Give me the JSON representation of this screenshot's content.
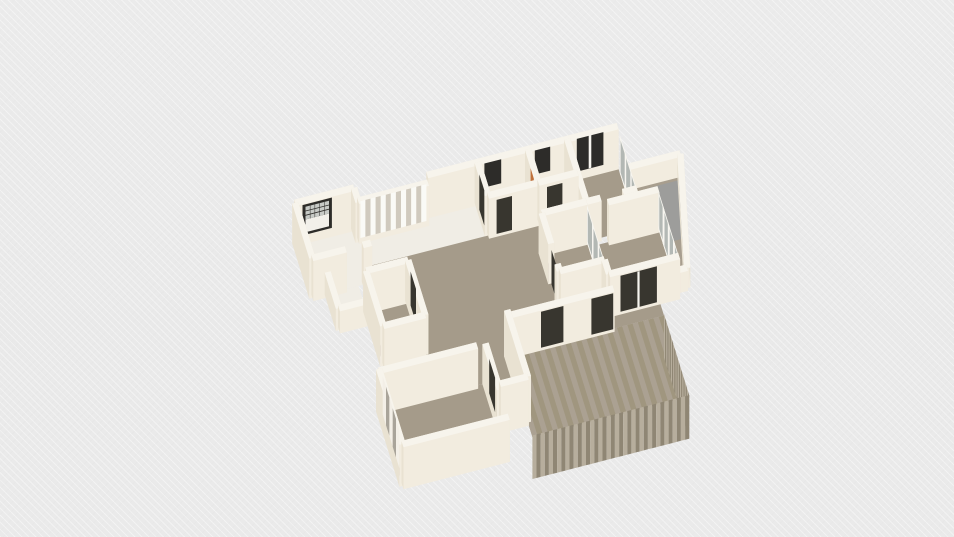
{
  "meta": {
    "app_context": "3d-floorplan-viewport",
    "background_color": "#ececec"
  },
  "view": {
    "ox": 340,
    "oy": 236,
    "ux": 28,
    "uy": -7.2,
    "vx": 9,
    "vy": 29,
    "zh": 40,
    "wall_t": 0.22
  },
  "palette": {
    "wallTop": "#f7f4ec",
    "wallH": "#f2ecdf",
    "wallV": "#e9e2d2",
    "floorWhite": "#f0ede5",
    "wood": "#a59b8a",
    "balconyFloor": "#a89e8e",
    "grayMat": "#9d9d9b",
    "deck": "#a89e8c",
    "deckA": "#aba192",
    "deckB": "#a0967f",
    "deckLight": "#b7ae9d",
    "deckDark": "#8f8674",
    "frameDark": "#2d2c29",
    "doorDark": "#38362f",
    "glass": "#b3b8b4",
    "glassLight": "#c7cac6",
    "mullion": "#f7f5ef",
    "slatLight": "#fafaf6",
    "slatDark": "#d0cabe",
    "wardrobeWhite": "#f3efe7",
    "wardrobeGray": "#a9a49a",
    "towelOrange": "#c0713c",
    "windowWhite": "#f2f0ea"
  },
  "scene": [
    {
      "k": "f",
      "n": "room-a-floor",
      "p": [
        [
          -1.45,
          -0.05
        ],
        [
          0.55,
          -0.05
        ],
        [
          0.55,
          1.75
        ],
        [
          -1.45,
          1.75
        ]
      ],
      "f": "floorWhite"
    },
    {
      "k": "f",
      "n": "entry-hall-floor",
      "p": [
        [
          0.55,
          0.1
        ],
        [
          4.9,
          0.1
        ],
        [
          4.9,
          1.25
        ],
        [
          0.55,
          1.25
        ]
      ],
      "f": "floorWhite"
    },
    {
      "k": "f",
      "n": "bath-1-floor",
      "p": [
        [
          4.9,
          0.05
        ],
        [
          6.7,
          0.05
        ],
        [
          6.7,
          1.2
        ],
        [
          4.9,
          1.2
        ]
      ],
      "f": "floorWhite"
    },
    {
      "k": "f",
      "n": "bath-2-floor",
      "p": [
        [
          6.7,
          0.05
        ],
        [
          8.1,
          0.05
        ],
        [
          8.1,
          1.2
        ],
        [
          6.7,
          1.2
        ]
      ],
      "f": "floorWhite"
    },
    {
      "k": "f",
      "n": "room-f-floor",
      "p": [
        [
          8.1,
          0.05
        ],
        [
          9.9,
          0.05
        ],
        [
          9.9,
          2.2
        ],
        [
          8.1,
          2.2
        ]
      ],
      "f": "wood"
    },
    {
      "k": "f",
      "n": "balcony-ne-floor",
      "p": [
        [
          9.9,
          0.8
        ],
        [
          11.9,
          0.8
        ],
        [
          11.4,
          3.0
        ],
        [
          10.95,
          4.5
        ],
        [
          10.6,
          4.5
        ],
        [
          10.6,
          2.5
        ],
        [
          9.9,
          2.5
        ]
      ],
      "f": "balconyFloor"
    },
    {
      "k": "f",
      "n": "balcony-ne-mat",
      "p": [
        [
          10.7,
          1.0
        ],
        [
          11.75,
          1.0
        ],
        [
          11.35,
          2.9
        ],
        [
          10.7,
          2.9
        ]
      ],
      "f": "grayMat"
    },
    {
      "k": "f",
      "n": "patio-floor",
      "p": [
        [
          -1.0,
          1.75
        ],
        [
          0.1,
          1.75
        ],
        [
          0.1,
          3.0
        ],
        [
          -1.0,
          3.0
        ]
      ],
      "f": "floorWhite"
    },
    {
      "k": "f",
      "n": "living-floor",
      "p": [
        [
          0.55,
          1.2
        ],
        [
          8.1,
          1.2
        ],
        [
          8.1,
          2.2
        ],
        [
          6.5,
          2.2
        ],
        [
          6.5,
          4.2
        ],
        [
          8.1,
          4.2
        ],
        [
          8.1,
          4.7
        ],
        [
          9.9,
          4.7
        ],
        [
          9.9,
          5.2
        ],
        [
          4.3,
          5.2
        ],
        [
          4.3,
          7.5
        ],
        [
          3.3,
          7.5
        ],
        [
          3.3,
          5.9
        ],
        [
          0.55,
          5.9
        ]
      ],
      "f": "wood"
    },
    {
      "k": "f",
      "n": "bedroom-right-floor",
      "p": [
        [
          8.1,
          2.4
        ],
        [
          10.6,
          2.4
        ],
        [
          10.6,
          4.7
        ],
        [
          8.1,
          4.7
        ]
      ],
      "f": "wood"
    },
    {
      "k": "f",
      "n": "room-i-floor",
      "p": [
        [
          6.5,
          2.2
        ],
        [
          8.1,
          2.2
        ],
        [
          8.1,
          4.2
        ],
        [
          6.5,
          4.2
        ]
      ],
      "f": "wood"
    },
    {
      "k": "f",
      "n": "closet-m-floor",
      "p": [
        [
          0.1,
          2.6
        ],
        [
          1.6,
          2.6
        ],
        [
          1.6,
          4.5
        ],
        [
          0.1,
          4.5
        ]
      ],
      "f": "wood"
    },
    {
      "k": "f",
      "n": "bedroom-sw-floor",
      "p": [
        [
          -0.5,
          5.9
        ],
        [
          3.3,
          5.9
        ],
        [
          3.3,
          8.5
        ],
        [
          -0.5,
          8.5
        ]
      ],
      "f": "wood"
    },
    {
      "k": "f",
      "n": "deck-floor",
      "p": [
        [
          4.3,
          5.2
        ],
        [
          9.9,
          5.2
        ],
        [
          9.9,
          8.0
        ],
        [
          4.3,
          8.0
        ]
      ],
      "f": "deck"
    },
    {
      "k": "fs",
      "n": "deck-floor-planks",
      "p": [
        [
          4.3,
          5.2
        ],
        [
          9.9,
          5.2
        ],
        [
          9.9,
          8.0
        ],
        [
          4.3,
          8.0
        ]
      ],
      "N": 30,
      "c1": "deckA",
      "c2": "deckB"
    },
    {
      "k": "w",
      "n": "balcony-ne-parapet-north",
      "a": [
        9.9,
        0.8
      ],
      "b": [
        11.9,
        0.8
      ],
      "h": 0.5
    },
    {
      "k": "w",
      "n": "north-exterior-wall",
      "a": [
        3.1,
        0.05
      ],
      "b": [
        9.9,
        0.05
      ]
    },
    {
      "k": "p",
      "n": "bath-1-window",
      "a": [
        5.15,
        0.02
      ],
      "b": [
        5.75,
        0.02
      ],
      "z0": 0.3,
      "z1": 0.9,
      "f": "frameDark"
    },
    {
      "k": "p",
      "n": "bath-2-window",
      "a": [
        6.95,
        0.02
      ],
      "b": [
        7.5,
        0.02
      ],
      "z0": 0.3,
      "z1": 0.9,
      "f": "frameDark"
    },
    {
      "k": "p",
      "n": "room-f-window",
      "a": [
        8.45,
        0.02
      ],
      "b": [
        9.4,
        0.02
      ],
      "z0": 0.1,
      "z1": 0.92,
      "f": "frameDark"
    },
    {
      "k": "p",
      "n": "room-f-window-mullion",
      "a": [
        8.88,
        0.01
      ],
      "b": [
        8.97,
        0.01
      ],
      "z0": 0.1,
      "z1": 0.92,
      "f": "mullion"
    },
    {
      "k": "w",
      "n": "balcony-ne-parapet-east",
      "a": [
        11.9,
        0.8
      ],
      "b": [
        10.95,
        4.5
      ],
      "h": 0.5
    },
    {
      "k": "w",
      "n": "balcony-ne-parapet-south",
      "a": [
        10.95,
        4.5
      ],
      "b": [
        10.6,
        4.5
      ],
      "h": 0.5
    },
    {
      "k": "g",
      "n": "room-f-east-glazing",
      "a": [
        9.9,
        0.3
      ],
      "b": [
        9.9,
        2.15
      ],
      "z1": 0.95,
      "N": 3
    },
    {
      "k": "w",
      "n": "room-a-north-wall",
      "a": [
        -1.55,
        -0.15
      ],
      "b": [
        0.55,
        -0.15
      ]
    },
    {
      "k": "wg",
      "n": "room-a-grid-window",
      "a": [
        -1.3,
        -0.12
      ],
      "b": [
        -0.25,
        -0.12
      ],
      "z0": 0.16,
      "z1": 0.92
    },
    {
      "k": "w",
      "n": "room-a-west-wall",
      "a": [
        -1.55,
        -0.15
      ],
      "b": [
        -1.55,
        1.75
      ]
    },
    {
      "k": "w",
      "n": "room-a-east-wall-stub",
      "a": [
        0.55,
        -0.15
      ],
      "b": [
        0.55,
        0.35
      ]
    },
    {
      "k": "w",
      "n": "closet-wall-slatted",
      "a": [
        0.55,
        0.3
      ],
      "b": [
        3.05,
        0.3
      ]
    },
    {
      "k": "s",
      "n": "closet-slat-doors",
      "a": [
        0.64,
        0.27
      ],
      "b": [
        3.0,
        0.27
      ],
      "z0": 0.03,
      "z1": 0.95,
      "N": 13,
      "c1": "slatLight",
      "c2": "slatDark"
    },
    {
      "k": "w",
      "n": "bath-1-west-wall",
      "a": [
        4.9,
        0.05
      ],
      "b": [
        4.9,
        1.2
      ]
    },
    {
      "k": "p",
      "n": "entry-door",
      "a": [
        4.88,
        0.3
      ],
      "b": [
        4.88,
        0.85
      ],
      "z0": 0,
      "z1": 0.88,
      "f": "doorDark"
    },
    {
      "k": "w",
      "n": "bath-divider-wall",
      "a": [
        6.7,
        0.05
      ],
      "b": [
        6.7,
        1.2
      ]
    },
    {
      "k": "p",
      "n": "towel",
      "a": [
        6.68,
        0.4
      ],
      "b": [
        6.68,
        0.75
      ],
      "z0": 0.45,
      "z1": 0.78,
      "f": "towelOrange"
    },
    {
      "k": "w",
      "n": "bath-2-east-wall",
      "a": [
        8.1,
        0.05
      ],
      "b": [
        8.1,
        2.2
      ]
    },
    {
      "k": "w",
      "n": "bath-1-south-wall",
      "a": [
        4.9,
        1.2
      ],
      "b": [
        6.7,
        1.2
      ]
    },
    {
      "k": "p",
      "n": "bath-1-door",
      "a": [
        5.2,
        1.22
      ],
      "b": [
        5.75,
        1.22
      ],
      "z0": 0,
      "z1": 0.85,
      "f": "doorDark"
    },
    {
      "k": "w",
      "n": "bath-2-south-wall",
      "a": [
        6.7,
        1.2
      ],
      "b": [
        8.1,
        1.2
      ]
    },
    {
      "k": "p",
      "n": "bath-2-door",
      "a": [
        7.0,
        1.22
      ],
      "b": [
        7.55,
        1.22
      ],
      "z0": 0,
      "z1": 0.85,
      "f": "doorDark"
    },
    {
      "k": "w",
      "n": "room-a-south-wall-left",
      "a": [
        -1.55,
        1.75
      ],
      "b": [
        -0.35,
        1.75
      ]
    },
    {
      "k": "w",
      "n": "room-a-south-wall-right",
      "a": [
        0.25,
        1.75
      ],
      "b": [
        0.55,
        1.75
      ]
    },
    {
      "k": "w",
      "n": "patio-west-low-wall",
      "a": [
        -1.0,
        1.75
      ],
      "b": [
        -1.0,
        3.0
      ],
      "h": 0.55
    },
    {
      "k": "w",
      "n": "patio-south-low-wall",
      "a": [
        -1.0,
        3.0
      ],
      "b": [
        0.1,
        3.0
      ],
      "h": 0.55
    },
    {
      "k": "w",
      "n": "room-f-south-wall-left",
      "a": [
        8.1,
        2.2
      ],
      "b": [
        8.6,
        2.2
      ]
    },
    {
      "k": "w",
      "n": "room-f-south-wall-right",
      "a": [
        9.4,
        2.2
      ],
      "b": [
        9.9,
        2.2
      ]
    },
    {
      "k": "w",
      "n": "room-i-north-wall",
      "a": [
        6.5,
        2.2
      ],
      "b": [
        8.1,
        2.2
      ]
    },
    {
      "k": "w",
      "n": "closet-m-north-wall",
      "a": [
        0.1,
        2.6
      ],
      "b": [
        1.6,
        2.6
      ]
    },
    {
      "k": "w",
      "n": "closet-m-west-wall",
      "a": [
        0.1,
        2.6
      ],
      "b": [
        0.1,
        4.5
      ]
    },
    {
      "k": "w",
      "n": "closet-m-east-wall",
      "a": [
        1.6,
        2.6
      ],
      "b": [
        1.6,
        4.5
      ]
    },
    {
      "k": "p",
      "n": "closet-m-door",
      "a": [
        1.62,
        2.8
      ],
      "b": [
        1.62,
        3.4
      ],
      "z0": 0,
      "z1": 0.85,
      "f": "doorDark"
    },
    {
      "k": "w",
      "n": "closet-m-south-wall",
      "a": [
        0.1,
        4.5
      ],
      "b": [
        1.6,
        4.5
      ]
    },
    {
      "k": "w",
      "n": "room-i-west-wall-upper",
      "a": [
        6.5,
        2.2
      ],
      "b": [
        6.5,
        3.25
      ]
    },
    {
      "k": "p",
      "n": "room-i-door",
      "a": [
        6.5,
        3.28
      ],
      "b": [
        6.5,
        3.92
      ],
      "z0": 0,
      "z1": 0.86,
      "f": "doorDark"
    },
    {
      "k": "w",
      "n": "room-i-west-wall-stub",
      "a": [
        6.5,
        3.95
      ],
      "b": [
        6.5,
        4.2
      ]
    },
    {
      "k": "g",
      "n": "room-i-glass-partition",
      "a": [
        8.1,
        2.25
      ],
      "b": [
        8.1,
        4.15
      ],
      "z1": 0.95,
      "N": 3
    },
    {
      "k": "w",
      "n": "room-i-south-wall",
      "a": [
        6.5,
        4.2
      ],
      "b": [
        8.1,
        4.2
      ]
    },
    {
      "k": "w",
      "n": "living-east-wall-stub",
      "a": [
        8.1,
        4.2
      ],
      "b": [
        8.1,
        4.7
      ]
    },
    {
      "k": "w",
      "n": "bedroom-right-north-wall",
      "a": [
        8.8,
        2.4
      ],
      "b": [
        10.6,
        2.4
      ]
    },
    {
      "k": "g",
      "n": "bedroom-right-window-wall",
      "a": [
        10.6,
        2.4
      ],
      "b": [
        10.6,
        4.7
      ],
      "z1": 0.97,
      "N": 4
    },
    {
      "k": "w",
      "n": "bedroom-right-south-wall",
      "a": [
        8.1,
        4.7
      ],
      "b": [
        10.6,
        4.7
      ]
    },
    {
      "k": "p",
      "n": "balcony-sliding-door",
      "a": [
        8.5,
        4.72
      ],
      "b": [
        9.8,
        4.72
      ],
      "z0": 0,
      "z1": 0.9,
      "f": "doorDark"
    },
    {
      "k": "p",
      "n": "balcony-sliding-door-divider",
      "a": [
        9.1,
        4.73
      ],
      "b": [
        9.18,
        4.73
      ],
      "z0": 0,
      "z1": 0.9,
      "f": "mullion"
    },
    {
      "k": "w",
      "n": "living-south-wall",
      "a": [
        4.3,
        5.2
      ],
      "b": [
        8.1,
        5.2
      ]
    },
    {
      "k": "p",
      "n": "deck-door-1",
      "a": [
        5.5,
        5.22
      ],
      "b": [
        6.3,
        5.22
      ],
      "z0": 0,
      "z1": 0.9,
      "f": "doorDark"
    },
    {
      "k": "p",
      "n": "deck-door-2",
      "a": [
        7.3,
        5.22
      ],
      "b": [
        8.08,
        5.22
      ],
      "z0": 0,
      "z1": 0.9,
      "f": "doorDark"
    },
    {
      "k": "w",
      "n": "bedroom-sw-north-wall",
      "a": [
        -0.5,
        5.9
      ],
      "b": [
        3.0,
        5.9
      ]
    },
    {
      "k": "w",
      "n": "bedroom-sw-west-wall",
      "a": [
        -0.5,
        5.9
      ],
      "b": [
        -0.5,
        8.5
      ],
      "h": 1.05
    },
    {
      "k": "s",
      "n": "wardrobe",
      "a": [
        -0.42,
        6.05
      ],
      "b": [
        -0.42,
        7.9
      ],
      "z0": 0,
      "z1": 0.96,
      "N": 5,
      "c1": "wardrobeWhite",
      "c2": "wardrobeGray"
    },
    {
      "k": "w",
      "n": "bedroom-sw-east-wall",
      "a": [
        3.3,
        5.9
      ],
      "b": [
        3.3,
        7.5
      ]
    },
    {
      "k": "p",
      "n": "bedroom-sw-door",
      "a": [
        3.32,
        6.25
      ],
      "b": [
        3.32,
        6.9
      ],
      "z0": 0,
      "z1": 0.86,
      "f": "doorDark"
    },
    {
      "k": "w",
      "n": "hall-east-wall",
      "a": [
        4.3,
        5.2
      ],
      "b": [
        4.3,
        7.5
      ],
      "h": 1.15
    },
    {
      "k": "w",
      "n": "hall-south-wall",
      "a": [
        3.3,
        7.5
      ],
      "b": [
        4.3,
        7.5
      ],
      "h": 1.15
    },
    {
      "k": "s",
      "n": "deck-fascia-east",
      "a": [
        9.9,
        5.2
      ],
      "b": [
        9.9,
        8.0
      ],
      "z0": -1.05,
      "z1": 0.04,
      "N": 22,
      "c1": "deckLight",
      "c2": "deckDark"
    },
    {
      "k": "s",
      "n": "deck-fascia-south",
      "a": [
        4.3,
        8.0
      ],
      "b": [
        9.9,
        8.0
      ],
      "z0": -1.05,
      "z1": 0.04,
      "N": 38,
      "c1": "deckLight",
      "c2": "deckDark"
    },
    {
      "k": "w",
      "n": "bedroom-sw-south-wall",
      "a": [
        -0.5,
        8.5
      ],
      "b": [
        3.3,
        8.5
      ],
      "h": 1.05
    }
  ]
}
